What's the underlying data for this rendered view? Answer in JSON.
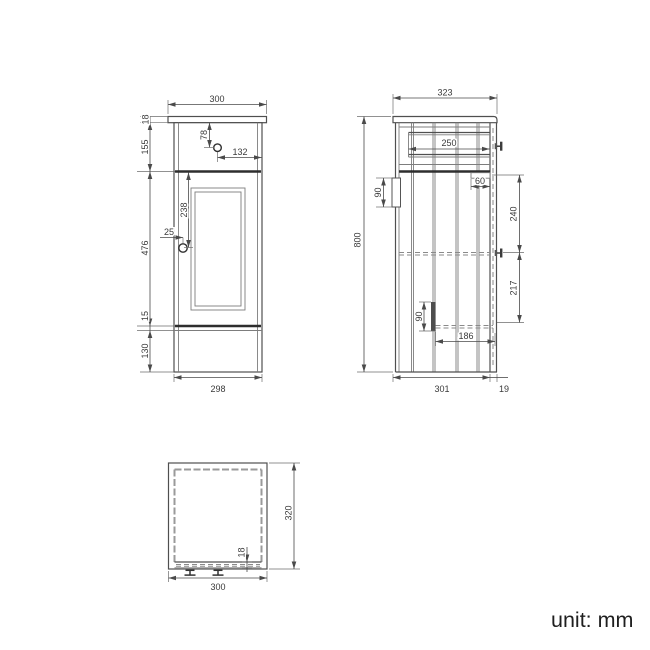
{
  "unit_note": "unit: mm",
  "front_view": {
    "dims": {
      "counter_width": "300",
      "counter_thickness": "18",
      "top_section_height": "155",
      "drawer_knob_from_top": "78",
      "drawer_knob_from_right": "132",
      "door_section_height": "476",
      "door_knob_from_top": "238",
      "door_knob_from_left": "25",
      "bottom_rail_height": "15",
      "plinth_height": "130",
      "body_width": "298"
    }
  },
  "side_view": {
    "dims": {
      "total_depth": "323",
      "total_height": "800",
      "drawer_depth": "250",
      "top_bracket_height": "90",
      "door_top_rail_depth": "60",
      "door_upper_span": "240",
      "door_lower_span": "217",
      "bottom_bracket_height": "90",
      "bottom_shelf_depth": "186",
      "body_depth": "301",
      "door_thickness": "19"
    }
  },
  "plan_view": {
    "dims": {
      "depth": "320",
      "front_panel_thickness": "18",
      "width": "300"
    }
  }
}
